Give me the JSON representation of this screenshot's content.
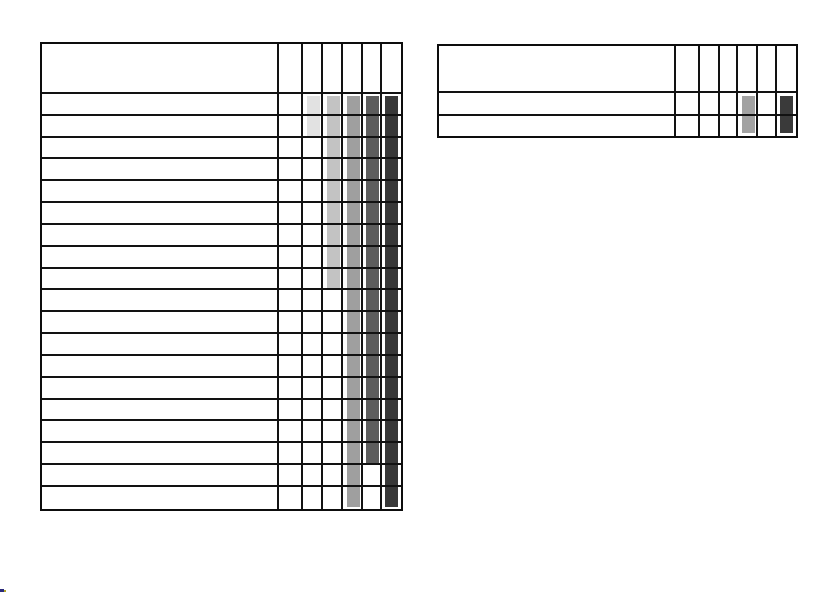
{
  "page": {
    "background": "#ffffff",
    "description": "Blank scanned gantt-chart template page with two grid tables and grayscale duration bars; no visible text"
  },
  "grid": {
    "line_color": "#121212",
    "outer_border_color": "#0d0d0d"
  },
  "artifact": {
    "colors": [
      "#2a2a7a",
      "#b0a428"
    ]
  },
  "chart_data": [
    {
      "type": "bar",
      "subtype": "gantt-grid",
      "id": "left",
      "title": "",
      "header_text": "",
      "label_column_cells": "empty",
      "num_value_columns": 6,
      "num_rows": 19,
      "bars": [
        {
          "value_column": 2,
          "start_row": 1,
          "end_row": 2,
          "color": "#e2e2e2"
        },
        {
          "value_column": 3,
          "start_row": 1,
          "end_row": 9,
          "color": "#c3c3c3"
        },
        {
          "value_column": 4,
          "start_row": 1,
          "end_row": 19,
          "color": "#9f9f9f"
        },
        {
          "value_column": 5,
          "start_row": 1,
          "end_row": 17,
          "color": "#5d5d5d"
        },
        {
          "value_column": 6,
          "start_row": 1,
          "end_row": 19,
          "color": "#383838"
        }
      ]
    },
    {
      "type": "bar",
      "subtype": "gantt-grid",
      "id": "right",
      "title": "",
      "header_text": "",
      "label_column_cells": "empty",
      "num_value_columns": 6,
      "num_rows": 2,
      "bars": [
        {
          "value_column": 4,
          "start_row": 1,
          "end_row": 2,
          "color": "#a2a2a2"
        },
        {
          "value_column": 6,
          "start_row": 1,
          "end_row": 2,
          "color": "#3a3a3a"
        }
      ]
    }
  ]
}
